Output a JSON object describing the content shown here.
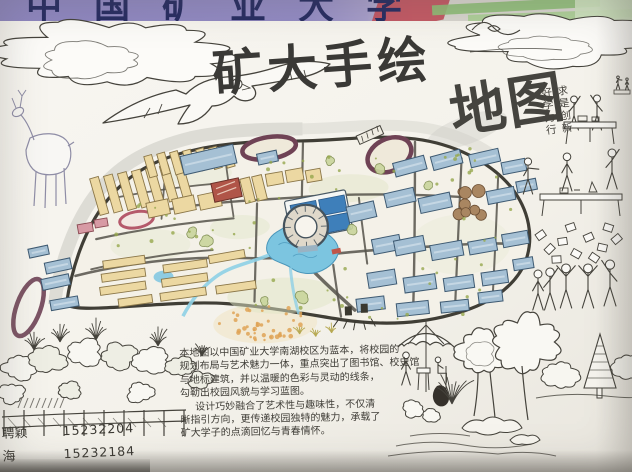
{
  "banner": {
    "text": "中国矿业大学"
  },
  "title": {
    "main": "矿大手绘",
    "sub": "地图"
  },
  "motto": {
    "col1": "求是创新",
    "col2": "好学力行"
  },
  "description": {
    "lines": [
      "本地图以中国矿业大学南湖校区为蓝本，将校园的",
      "规划布局与艺术魅力一体，重点突出了图书馆、校史馆",
      "与地标建筑，并以温暖的色彩与灵动的线条，",
      "勾勒出校园风貌与学习蓝图。",
      "设计巧妙融合了艺术性与趣味性，不仅清",
      "晰指引方向，更传递校园独特的魅力，承载了",
      "矿大学子的点滴回忆与青春情怀。"
    ]
  },
  "credits": [
    {
      "name": "聘颖",
      "id": "15232204"
    },
    {
      "name": "海",
      "id": "15232184"
    }
  ],
  "palette": {
    "ink": "#45433c",
    "road": "#55524a",
    "boundary": "#403e36",
    "dorm": "#ecd8a2",
    "dormStroke": "#8a7648",
    "roof": "#a5c0d4",
    "roofStroke": "#3e5a72",
    "roofLight": "#c9dae6",
    "water": "#7cc5e0",
    "waterDark": "#4a96ba",
    "track": "#6f4255",
    "trackSmall": "#b5596b",
    "red": "#b05548",
    "pink": "#d79aa4",
    "brown": "#a98661",
    "green": "#96a84e",
    "wash": "#dfe5c6",
    "orange": "#dfa356",
    "bannerPurple": "#8e86c0",
    "bannerText": "#272c62",
    "bannerRed": "#c14f5c",
    "bannerGreen": "#8fbe77"
  }
}
